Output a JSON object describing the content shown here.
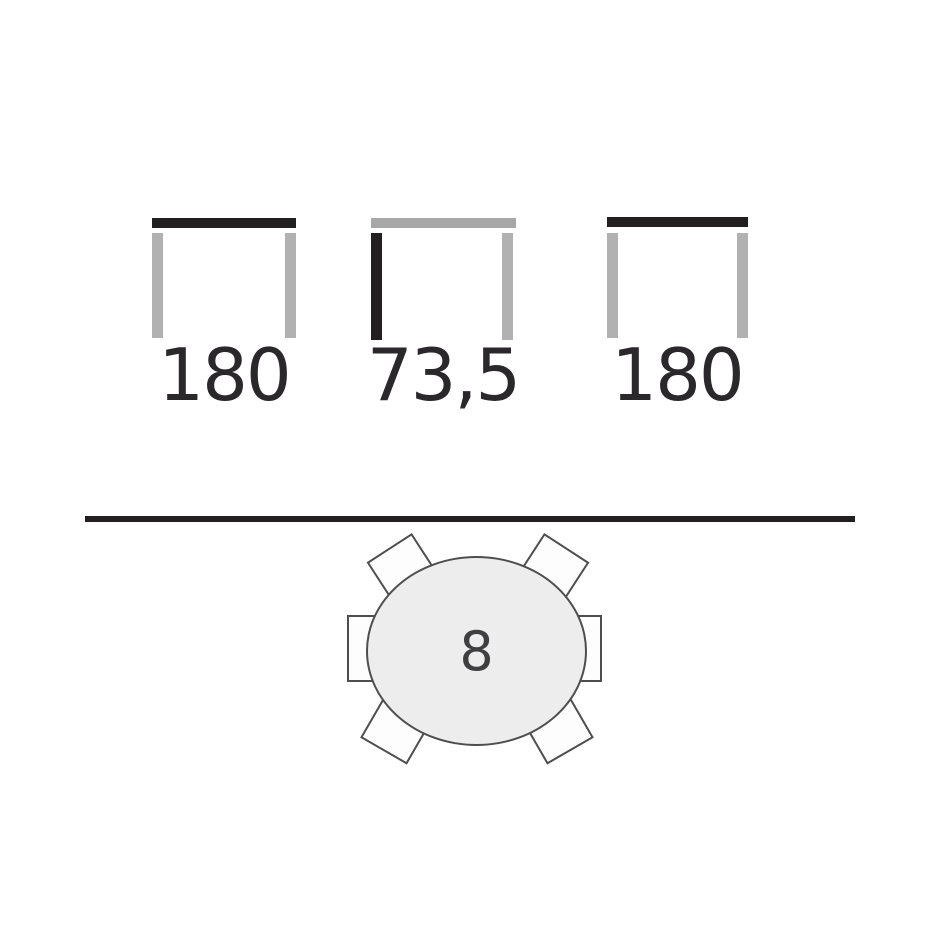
{
  "diagram": {
    "title": "Table dimensions and seating plan diagram",
    "dimension_views": [
      {
        "id": "width-view-1",
        "label": "180",
        "highlight": "tabletop",
        "tabletop_color": "dark",
        "left_leg_color": "gray",
        "right_leg_color": "gray"
      },
      {
        "id": "height-view",
        "label": "73,5",
        "highlight": "leg",
        "tabletop_color": "gray",
        "left_leg_color": "dark",
        "right_leg_color": "gray"
      },
      {
        "id": "width-view-2",
        "label": "180",
        "highlight": "tabletop",
        "tabletop_color": "dark",
        "left_leg_color": "gray",
        "right_leg_color": "gray"
      }
    ],
    "seating_plan": {
      "seats_label": "8",
      "table_shape": "oval",
      "chairs_visible": 6
    }
  },
  "colors": {
    "ink": "#231f20",
    "gray": "#aeadad",
    "table_fill": "#ededed",
    "outline": "#4e4e4e",
    "chair_fill": "#fdfdfd",
    "background": "#ffffff"
  }
}
